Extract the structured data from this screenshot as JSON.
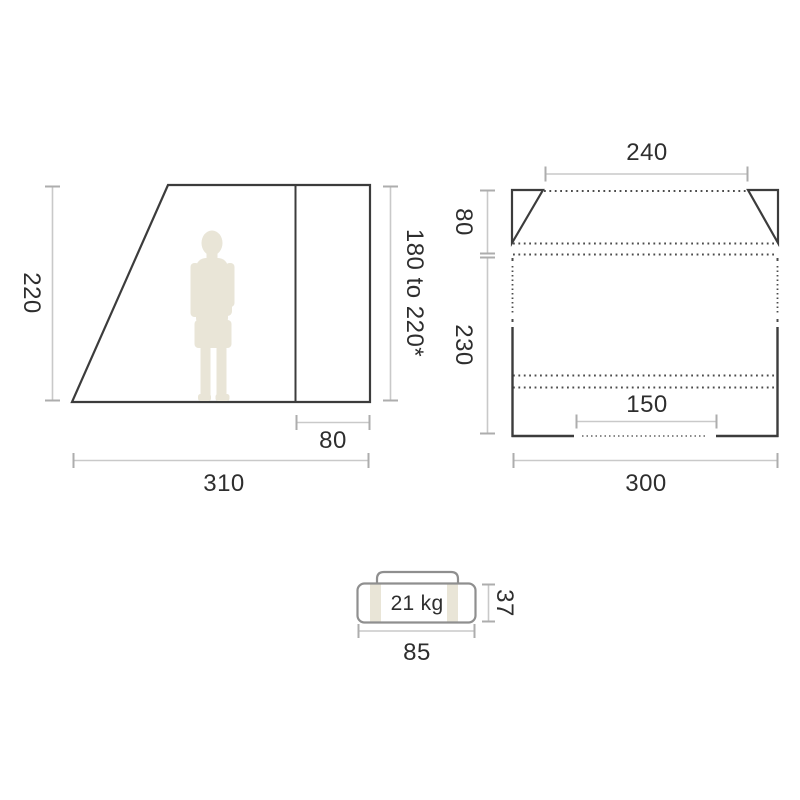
{
  "side_view": {
    "height": "220",
    "peak_height_range": "180 to 220*",
    "rear_section_width": "80",
    "total_width": "310"
  },
  "top_view": {
    "front_opening_width": "240",
    "front_depth": "80",
    "main_depth": "230",
    "rear_opening_width": "150",
    "total_width": "300"
  },
  "pack": {
    "weight": "21 kg",
    "height": "37",
    "length": "85"
  },
  "colors": {
    "outline": "#3c3c3c",
    "dotted_line": "#4c4c4c",
    "dimension_line": "#c9c9c9",
    "dimension_tick": "#adadad",
    "bag_outline": "#8f8f8f",
    "silhouette": "#e9e5d7",
    "text": "#2e2e2e",
    "background": "#ffffff"
  }
}
